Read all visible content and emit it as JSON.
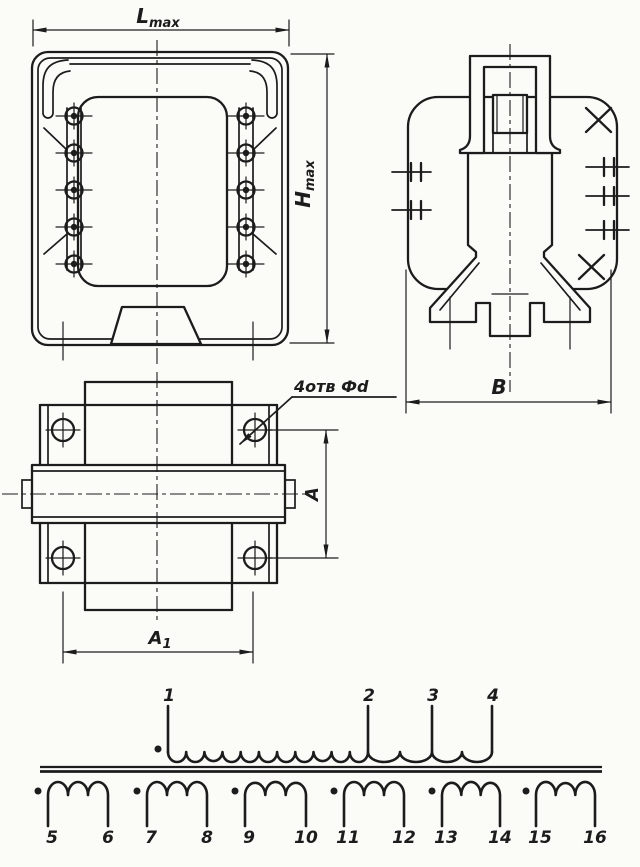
{
  "page": {
    "ink": "#1c1c1c",
    "paper": "#fbfbf8"
  },
  "dimensions": {
    "l_max": {
      "base": "L",
      "sub": "max"
    },
    "h_max": {
      "base": "H",
      "sub": "max"
    },
    "b": {
      "base": "B"
    },
    "a": {
      "base": "A"
    },
    "a1": {
      "base": "A",
      "sub": "1"
    },
    "holes_note": "4отв Фd"
  },
  "schematic": {
    "primary": {
      "terminals": [
        "1",
        "2",
        "3",
        "4"
      ]
    },
    "secondaries": [
      {
        "start": "5",
        "end": "6"
      },
      {
        "start": "7",
        "end": "8"
      },
      {
        "start": "9",
        "end": "10"
      },
      {
        "start": "11",
        "end": "12"
      },
      {
        "start": "13",
        "end": "14"
      },
      {
        "start": "15",
        "end": "16"
      }
    ]
  }
}
